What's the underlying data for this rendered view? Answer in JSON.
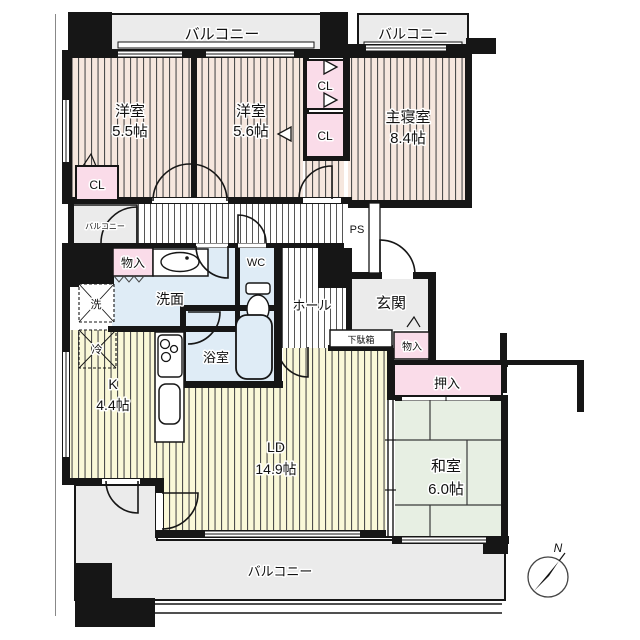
{
  "compass": {
    "north": "N"
  },
  "balconies": {
    "top_left": "バルコニー",
    "top_right": "バルコニー",
    "side": "バルコニー",
    "bottom": "バルコニー"
  },
  "rooms": {
    "western1": {
      "name": "洋室",
      "size": "5.5帖"
    },
    "western2": {
      "name": "洋室",
      "size": "5.6帖"
    },
    "master": {
      "name": "主寝室",
      "size": "8.4帖"
    },
    "japanese": {
      "name": "和室",
      "size": "6.0帖"
    },
    "living": {
      "name": "LD",
      "size": "14.9帖"
    },
    "kitchen": {
      "name": "K",
      "size": "4.4帖"
    },
    "washroom": {
      "name": "洗面"
    },
    "bath": {
      "name": "浴室"
    },
    "toilet": {
      "name": "WC"
    },
    "hall": {
      "name": "ホール"
    },
    "entry": {
      "name": "玄関"
    }
  },
  "storage": {
    "closet_left": "CL",
    "closet_upper": "CL",
    "closet_lower": "CL",
    "oshiire": "押入",
    "monoire_utility": "物入",
    "monoire_entry": "物入",
    "shoe_cabinet": "下駄箱"
  },
  "fixtures": {
    "washer": "洗",
    "fridge": "冷"
  },
  "utilities": {
    "pipe_space": "PS"
  },
  "colors": {
    "bedroom_fill": "#f6e7de",
    "living_fill": "#faf8d8",
    "tatami_fill": "#e7efe3",
    "wet_fill": "#dfecf6",
    "closet_fill": "#fadce9",
    "balcony_fill": "#ebebeb",
    "wall": "#161616"
  }
}
